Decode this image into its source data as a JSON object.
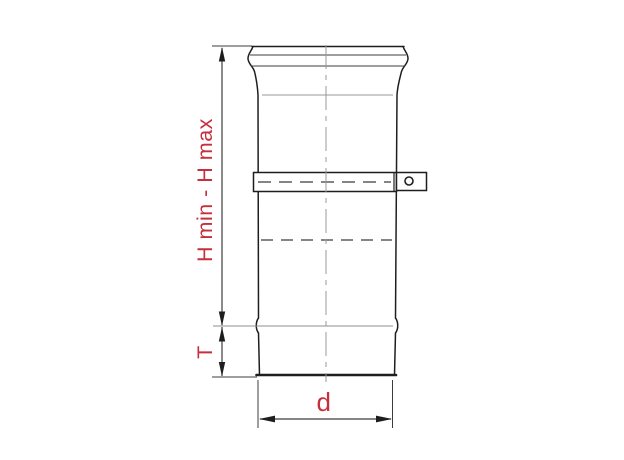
{
  "colors": {
    "accent_red": "#c62f3c",
    "line_dark": "#1e1e1e",
    "line_mid": "#3c3c3c",
    "line_light": "#8f8f8f"
  },
  "labels": {
    "h_dimension": "H min - H max",
    "t_dimension": "T",
    "d_dimension": "d"
  }
}
